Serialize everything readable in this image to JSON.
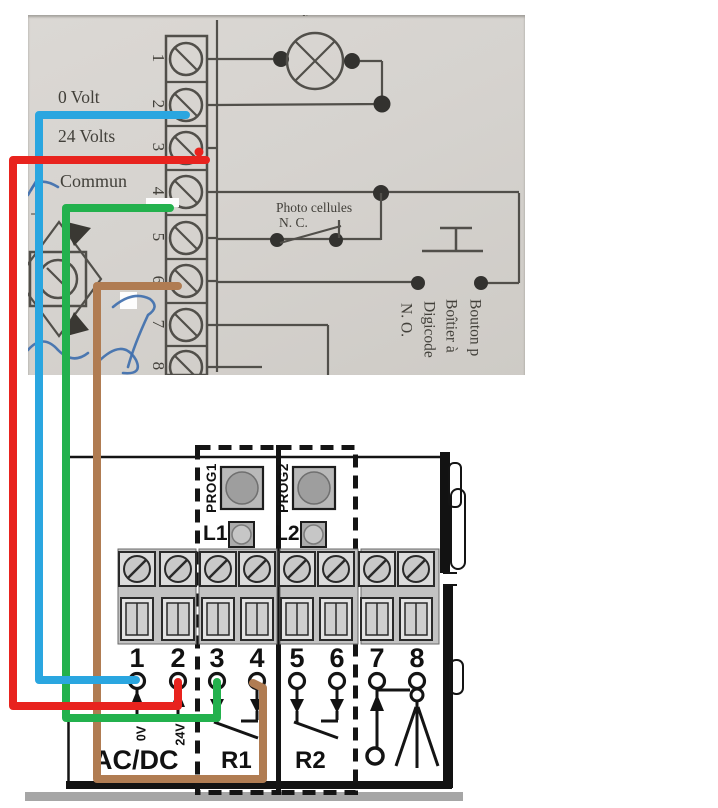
{
  "colors": {
    "wire_red": "#e8231e",
    "wire_blue": "#2aa6e0",
    "wire_green": "#23b14d",
    "wire_brown": "#b07c52",
    "pen_blue": "#3f6fae",
    "photo_bg": "#d6d3cf",
    "schematic_line": "#514f4a",
    "schematic_dot": "#33322f",
    "module_line": "#141414"
  },
  "photo": {
    "terminal_numbers": [
      "1",
      "2",
      "3",
      "4",
      "5",
      "6",
      "7",
      "8"
    ],
    "labels": {
      "volt0": "0 Volt",
      "volts24": "24 Volts",
      "commun": "Commun",
      "plus": "+",
      "minus": "-",
      "photocells": "Photo cellules",
      "photocells_type": "N. C.",
      "top_fragment_a": "ts",
      "top_fragment_b": "s"
    },
    "rotated_labels": {
      "bouton": "Bouton p",
      "boitier": "Boîtier à",
      "digicode": "Digicode",
      "no": "N. O."
    }
  },
  "module": {
    "terminal_numbers": [
      "1",
      "2",
      "3",
      "4",
      "5",
      "6",
      "7",
      "8"
    ],
    "labels": {
      "prog1": "PROG1",
      "prog2": "PROG2",
      "l1": "L1",
      "l2": "L2",
      "v0": "0V",
      "v24": "24V",
      "acdc": "AC/DC",
      "r1": "R1",
      "r2": "R2"
    }
  }
}
